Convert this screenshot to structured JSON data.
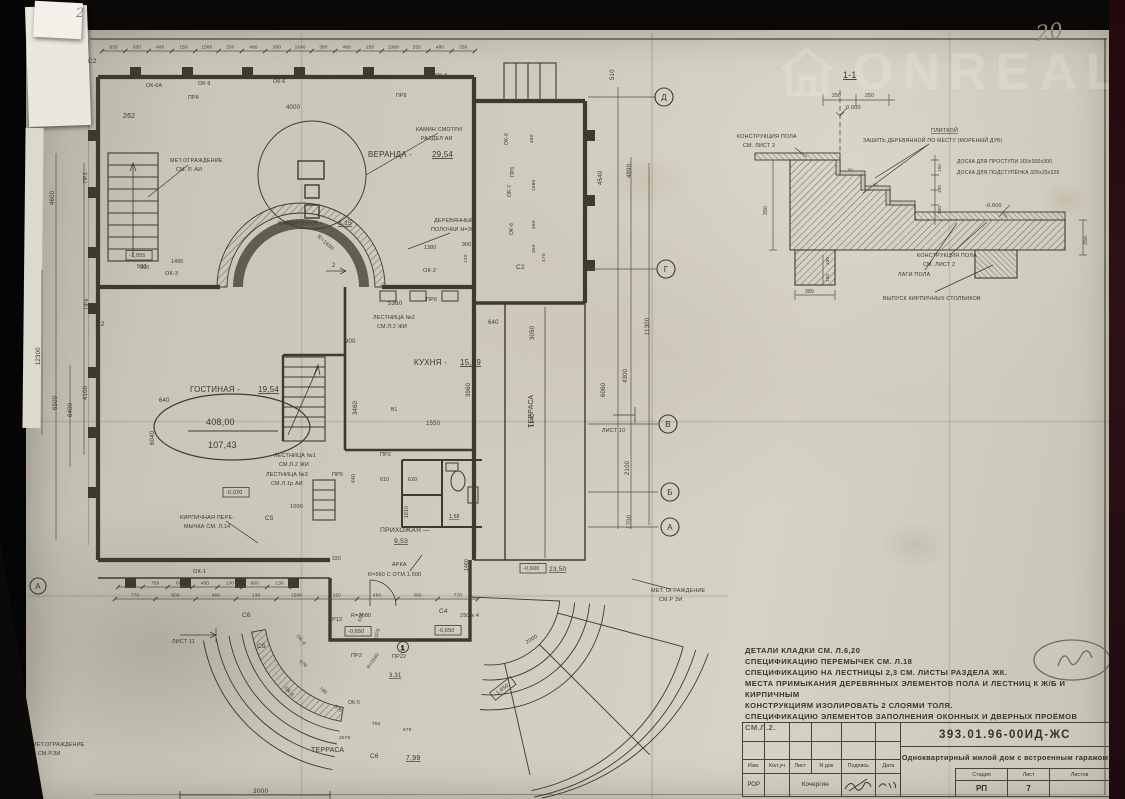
{
  "sheet": {
    "handwritten_page_number": "20",
    "handwritten_corner_note": "2",
    "watermark_text": "ONREAL"
  },
  "plan": {
    "axes_right": [
      {
        "l": "Д",
        "x": 634,
        "y": 62
      },
      {
        "l": "Г",
        "x": 636,
        "y": 234
      },
      {
        "l": "В",
        "x": 638,
        "y": 389
      },
      {
        "l": "Б",
        "x": 640,
        "y": 457
      },
      {
        "l": "А",
        "x": 640,
        "y": 492
      }
    ],
    "axes_left": [
      {
        "l": "А",
        "x": 8,
        "y": 551
      }
    ],
    "chains": [
      {
        "y": 16,
        "x0": 72,
        "x1": 445,
        "values": [
          "835",
          "330",
          "480",
          "150",
          "1580",
          "250",
          "480",
          "360",
          "1640",
          "380",
          "480",
          "250",
          "1380",
          "250",
          "480",
          "330"
        ]
      },
      {
        "y": 552,
        "x0": 88,
        "x1": 262,
        "values": [
          "130",
          "750",
          "600",
          "450",
          "130",
          "600",
          "130"
        ]
      },
      {
        "y": 564,
        "x0": 85,
        "x1": 448,
        "values": [
          "770",
          "500",
          "460",
          "130",
          "1580",
          "150",
          "460",
          "360",
          "770"
        ]
      }
    ],
    "labels": [
      {
        "t": "ПР8",
        "x": 158,
        "y": 64,
        "s": 5.2
      },
      {
        "t": "ОК-6А",
        "x": 116,
        "y": 52,
        "s": 5.2
      },
      {
        "t": "ОК-9",
        "x": 168,
        "y": 50,
        "s": 5.2
      },
      {
        "t": "ОК-6",
        "x": 243,
        "y": 48,
        "s": 5.2
      },
      {
        "t": "ОК-6А",
        "x": 308,
        "y": 44,
        "s": 5.2
      },
      {
        "t": "ОК-7",
        "x": 348,
        "y": 44,
        "s": 5.2
      },
      {
        "t": "ОК-6",
        "x": 405,
        "y": 42,
        "s": 5.2
      },
      {
        "t": "ПР8",
        "x": 366,
        "y": 62,
        "s": 5.2
      },
      {
        "t": "4000",
        "x": 256,
        "y": 74,
        "s": 6
      },
      {
        "t": "262",
        "x": 93,
        "y": 83,
        "s": 7,
        "c": "#7d7a6e"
      },
      {
        "t": "ПР3",
        "x": 57,
        "y": 148,
        "s": 5.2,
        "r": -90
      },
      {
        "t": "ОК-4",
        "x": 70,
        "y": 175,
        "s": 5.2,
        "r": -90
      },
      {
        "t": "ОК-6А",
        "x": 70,
        "y": 214,
        "s": 5.2,
        "r": -90
      },
      {
        "t": "ПР6",
        "x": 58,
        "y": 274,
        "s": 5.2,
        "r": -90
      },
      {
        "t": "ОК-3",
        "x": 135,
        "y": 240,
        "s": 5.5
      },
      {
        "t": "ОК-2",
        "x": 393,
        "y": 237,
        "s": 5.5
      },
      {
        "t": "4600",
        "x": 24,
        "y": 170,
        "s": 6,
        "r": -90
      },
      {
        "t": "12300",
        "x": 10,
        "y": 330,
        "s": 6,
        "r": -90
      },
      {
        "t": "6500",
        "x": 27,
        "y": 375,
        "s": 6,
        "r": -90
      },
      {
        "t": "6400",
        "x": 42,
        "y": 382,
        "s": 6,
        "r": -90
      },
      {
        "t": "4100",
        "x": 57,
        "y": 365,
        "s": 6,
        "r": -90
      },
      {
        "t": "6040",
        "x": 124,
        "y": 410,
        "s": 6,
        "r": -90
      },
      {
        "t": "3460",
        "x": 327,
        "y": 380,
        "s": 6,
        "r": -90
      },
      {
        "t": "3960",
        "x": 440,
        "y": 362,
        "s": 6,
        "r": -90
      },
      {
        "t": "1810",
        "x": 378,
        "y": 483,
        "s": 5,
        "r": -90
      },
      {
        "t": "1460",
        "x": 438,
        "y": 536,
        "s": 5,
        "r": -90
      },
      {
        "t": "3050",
        "x": 504,
        "y": 305,
        "s": 6,
        "r": -90
      },
      {
        "t": "1140",
        "x": 504,
        "y": 392,
        "s": 6,
        "r": -90
      },
      {
        "t": "900",
        "x": 315,
        "y": 308,
        "s": 6
      },
      {
        "t": "5360",
        "x": 358,
        "y": 270,
        "s": 6
      },
      {
        "t": "1550",
        "x": 396,
        "y": 390,
        "s": 6
      },
      {
        "t": "640",
        "x": 458,
        "y": 289,
        "s": 6
      },
      {
        "t": "640",
        "x": 129,
        "y": 367,
        "s": 6
      },
      {
        "t": "610",
        "x": 350,
        "y": 446,
        "s": 5.2
      },
      {
        "t": "620",
        "x": 378,
        "y": 446,
        "s": 5.2
      },
      {
        "t": "1000",
        "x": 260,
        "y": 473,
        "s": 5.5
      },
      {
        "t": "320",
        "x": 302,
        "y": 525,
        "s": 5
      },
      {
        "t": "440",
        "x": 325,
        "y": 448,
        "s": 5,
        "r": -90
      },
      {
        "t": "23,50",
        "x": 519,
        "y": 536,
        "s": 6.5,
        "u": true
      },
      {
        "t": "ГОСТИНАЯ -",
        "x": 160,
        "y": 357,
        "s": 8
      },
      {
        "t": "19,54",
        "x": 228,
        "y": 357,
        "s": 8,
        "u": true
      },
      {
        "t": "408,00",
        "x": 176,
        "y": 390,
        "s": 9
      },
      {
        "t": "107,43",
        "x": 178,
        "y": 413,
        "s": 9
      },
      {
        "t": "КУХНЯ -",
        "x": 384,
        "y": 330,
        "s": 8
      },
      {
        "t": "15,09",
        "x": 430,
        "y": 330,
        "s": 8,
        "u": true
      },
      {
        "t": "ВЕРАНДА -",
        "x": 338,
        "y": 122,
        "s": 8
      },
      {
        "t": "29,54",
        "x": 402,
        "y": 122,
        "s": 8,
        "u": true
      },
      {
        "t": "КАМИННАЯ -",
        "x": 248,
        "y": 190,
        "s": 6.8
      },
      {
        "t": "6,15",
        "x": 308,
        "y": 190,
        "s": 6.8,
        "u": true
      },
      {
        "t": "ПРИХОЖАЯ —",
        "x": 350,
        "y": 497,
        "s": 6.8
      },
      {
        "t": "9,53",
        "x": 364,
        "y": 508,
        "s": 6.8,
        "u": true
      },
      {
        "t": "ТЕРРАСА",
        "x": 503,
        "y": 393,
        "s": 7,
        "r": -90
      },
      {
        "t": "ТЕРРАСА",
        "x": 281,
        "y": 717,
        "s": 7
      },
      {
        "t": "7,99",
        "x": 376,
        "y": 725,
        "s": 7,
        "u": true
      },
      {
        "t": "3,31",
        "x": 359,
        "y": 642,
        "s": 6,
        "u": true
      },
      {
        "t": "1,58",
        "x": 419,
        "y": 483,
        "s": 5,
        "u": true
      },
      {
        "t": "МЕТ.ОГРАЖДЕНИЕ",
        "x": 140,
        "y": 127,
        "s": 5.4
      },
      {
        "t": "СМ. Р. АИ",
        "x": 146,
        "y": 136,
        "s": 5.4
      },
      {
        "t": "КАМИН СМОТРИ",
        "x": 386,
        "y": 96,
        "s": 5.4
      },
      {
        "t": "РАЗДЕЛ АИ",
        "x": 391,
        "y": 105,
        "s": 5.4
      },
      {
        "t": "ДЕРЕВЯННЫЕ",
        "x": 404,
        "y": 187,
        "s": 5.4
      },
      {
        "t": "ПОЛОЧКИ Н=30",
        "x": 401,
        "y": 196,
        "s": 5.4
      },
      {
        "t": "R=1650",
        "x": 287,
        "y": 202,
        "s": 5.4,
        "r": 42
      },
      {
        "t": "ЛЕСТНИЦА №2",
        "x": 343,
        "y": 284,
        "s": 5.4
      },
      {
        "t": "СМ.Л.2 ЖИ",
        "x": 347,
        "y": 293,
        "s": 5.4
      },
      {
        "t": "ЛЕСТНИЦА №1",
        "x": 244,
        "y": 422,
        "s": 5.4
      },
      {
        "t": "СМ.Л.2 ЖИ",
        "x": 249,
        "y": 431,
        "s": 5.4
      },
      {
        "t": "ЛЕСТНИЦА №3",
        "x": 236,
        "y": 441,
        "s": 5.4
      },
      {
        "t": "СМ.Л.1р АИ",
        "x": 241,
        "y": 450,
        "s": 5.4
      },
      {
        "t": "КИРПИЧНАЯ ПЕРЕ-",
        "x": 150,
        "y": 484,
        "s": 5.4
      },
      {
        "t": "МЫЧКА СМ. Л.14",
        "x": 154,
        "y": 493,
        "s": 5.4
      },
      {
        "t": "АРКА",
        "x": 362,
        "y": 531,
        "s": 5.4
      },
      {
        "t": "R=560 С ОТМ.1,500",
        "x": 338,
        "y": 541,
        "s": 5.4
      },
      {
        "t": "МЕТ. ОГРАЖДЕНИЕ",
        "x": 621,
        "y": 557,
        "s": 5.4
      },
      {
        "t": "СМ.Р ЗИ",
        "x": 629,
        "y": 566,
        "s": 5.4
      },
      {
        "t": "МЕТ.ОГРАЖДЕНИЕ",
        "x": 2,
        "y": 711,
        "s": 5.4
      },
      {
        "t": "СМ.Р.ЗИ",
        "x": 8,
        "y": 720,
        "s": 5.4
      },
      {
        "t": "ЛИСТ 10",
        "x": 572,
        "y": 397,
        "s": 5.4
      },
      {
        "t": "ЛИСТ 11",
        "x": 142,
        "y": 608,
        "s": 5.4
      },
      {
        "t": "С2",
        "x": 58,
        "y": 28,
        "s": 6.5
      },
      {
        "t": "С2",
        "x": 66,
        "y": 291,
        "s": 6.5
      },
      {
        "t": "С2",
        "x": 486,
        "y": 234,
        "s": 6.5
      },
      {
        "t": "С4",
        "x": 409,
        "y": 578,
        "s": 6.5
      },
      {
        "t": "С5",
        "x": 235,
        "y": 485,
        "s": 6.5
      },
      {
        "t": "С5",
        "x": 227,
        "y": 613,
        "s": 6.5
      },
      {
        "t": "С6",
        "x": 212,
        "y": 582,
        "s": 6.5
      },
      {
        "t": "С6",
        "x": 340,
        "y": 723,
        "s": 6.5
      },
      {
        "t": "ПР2",
        "x": 350,
        "y": 421,
        "s": 5.4
      },
      {
        "t": "ПР5",
        "x": 302,
        "y": 441,
        "s": 5.4
      },
      {
        "t": "ПР2",
        "x": 321,
        "y": 622,
        "s": 5.4
      },
      {
        "t": "ПР6",
        "x": 396,
        "y": 266,
        "s": 5.4
      },
      {
        "t": "ОК-5",
        "x": 254,
        "y": 653,
        "s": 5,
        "r": 50
      },
      {
        "t": "ОК-5",
        "x": 318,
        "y": 669,
        "s": 5
      },
      {
        "t": "ОК-4",
        "x": 266,
        "y": 601,
        "s": 5,
        "r": 50
      },
      {
        "t": "ПР12",
        "x": 298,
        "y": 586,
        "s": 5.4
      },
      {
        "t": "R=2080",
        "x": 321,
        "y": 582,
        "s": 5.4
      },
      {
        "t": "ПР22",
        "x": 362,
        "y": 623,
        "s": 5.4
      },
      {
        "t": "250 х 4",
        "x": 430,
        "y": 582,
        "s": 5.4
      },
      {
        "t": "2000",
        "x": 497,
        "y": 609,
        "s": 5.4,
        "r": -32
      },
      {
        "t": "518",
        "x": 331,
        "y": 587,
        "s": 4.8,
        "r": -75
      },
      {
        "t": "1070",
        "x": 347,
        "y": 605,
        "s": 4.8,
        "r": -75
      },
      {
        "t": "R=2540",
        "x": 339,
        "y": 634,
        "s": 4.8,
        "r": -55
      },
      {
        "t": "-0,020",
        "x": 196,
        "y": 459,
        "s": 5.4,
        "b": true
      },
      {
        "t": "-0,600",
        "x": 493,
        "y": 535,
        "s": 5.4,
        "b": true
      },
      {
        "t": "-0,650",
        "x": 318,
        "y": 598,
        "s": 5.4,
        "b": true
      },
      {
        "t": "-0,650",
        "x": 408,
        "y": 597,
        "s": 5.4,
        "b": true
      },
      {
        "t": "-1,650",
        "x": 466,
        "y": 661,
        "s": 5.4,
        "b": true,
        "r": -38
      },
      {
        "t": "-1,055",
        "x": 99,
        "y": 222,
        "s": 5.4,
        "b": true
      },
      {
        "t": "500",
        "x": 107,
        "y": 233,
        "s": 5.4
      },
      {
        "t": "570",
        "x": 269,
        "y": 627,
        "s": 4.8,
        "r": 40
      },
      {
        "t": "780",
        "x": 289,
        "y": 654,
        "s": 4.8,
        "r": 40
      },
      {
        "t": "570",
        "x": 304,
        "y": 672,
        "s": 4.8,
        "r": 40
      },
      {
        "t": "750",
        "x": 342,
        "y": 690,
        "s": 4.8
      },
      {
        "t": "675",
        "x": 373,
        "y": 696,
        "s": 4.8
      },
      {
        "t": "2570",
        "x": 309,
        "y": 704,
        "s": 4.8
      },
      {
        "t": "1490",
        "x": 141,
        "y": 228,
        "s": 5.2
      },
      {
        "t": "900",
        "x": 110,
        "y": 234,
        "s": 5.2
      },
      {
        "t": "1380",
        "x": 394,
        "y": 214,
        "s": 5.2
      },
      {
        "t": "900",
        "x": 432,
        "y": 211,
        "s": 5.2
      },
      {
        "t": "120",
        "x": 437,
        "y": 228,
        "s": 4.8,
        "r": -90
      },
      {
        "t": "ОК-6",
        "x": 478,
        "y": 110,
        "s": 5,
        "r": -90
      },
      {
        "t": "ПР6",
        "x": 484,
        "y": 142,
        "s": 5,
        "r": -90
      },
      {
        "t": "ОК-7",
        "x": 481,
        "y": 162,
        "s": 5,
        "r": -90
      },
      {
        "t": "ОК-6",
        "x": 483,
        "y": 200,
        "s": 5,
        "r": -90
      },
      {
        "t": "480",
        "x": 503,
        "y": 108,
        "s": 4.8,
        "r": -90
      },
      {
        "t": "1580",
        "x": 505,
        "y": 156,
        "s": 4.8,
        "r": -90
      },
      {
        "t": "480",
        "x": 505,
        "y": 194,
        "s": 4.8,
        "r": -90
      },
      {
        "t": "360",
        "x": 505,
        "y": 218,
        "s": 4.8,
        "r": -90
      },
      {
        "t": "470",
        "x": 515,
        "y": 227,
        "s": 4.8,
        "r": -90
      },
      {
        "t": "510",
        "x": 584,
        "y": 45,
        "s": 6,
        "r": -90
      },
      {
        "t": "4540",
        "x": 572,
        "y": 150,
        "s": 6,
        "r": -90
      },
      {
        "t": "4890",
        "x": 601,
        "y": 143,
        "s": 6,
        "r": -90
      },
      {
        "t": "6060",
        "x": 575,
        "y": 362,
        "s": 6,
        "r": -90
      },
      {
        "t": "4300",
        "x": 597,
        "y": 348,
        "s": 6,
        "r": -90
      },
      {
        "t": "11300",
        "x": 619,
        "y": 300,
        "s": 6,
        "r": -90
      },
      {
        "t": "2100",
        "x": 599,
        "y": 440,
        "s": 6,
        "r": -90
      },
      {
        "t": "1700",
        "x": 601,
        "y": 494,
        "s": 6,
        "r": -90
      },
      {
        "t": "3000",
        "x": 223,
        "y": 758,
        "s": 6.5
      },
      {
        "t": "В1",
        "x": 361,
        "y": 376,
        "s": 5
      },
      {
        "t": "ОК-1",
        "x": 163,
        "y": 538,
        "s": 5.5
      },
      {
        "t": "2",
        "x": 302,
        "y": 232,
        "s": 6
      }
    ]
  },
  "detail": {
    "labels": [
      {
        "t": "1-1",
        "x": 108,
        "y": 18,
        "s": 9,
        "u": true
      },
      {
        "t": "КОНСТРУКЦИЯ ПОЛА",
        "x": 2,
        "y": 78,
        "s": 5.4
      },
      {
        "t": "СМ. ЛИСТ 2",
        "x": 8,
        "y": 87,
        "s": 5.4
      },
      {
        "t": "ПЛИТКОЙ",
        "x": 196,
        "y": 72,
        "s": 5.4,
        "u": true
      },
      {
        "t": "ЗАШИТЬ ДЕРЕВЯННОЙ ПО МЕСТУ (МОРЕНЫЙ ДУБ)",
        "x": 128,
        "y": 82,
        "s": 5.2
      },
      {
        "t": "ДОСКА ДЛЯ ПРОСТУПИ 300х300х300",
        "x": 222,
        "y": 103,
        "s": 5
      },
      {
        "t": "ДОСКА ДЛЯ ПОДСТУПЁНКА 325х25х325",
        "x": 222,
        "y": 114,
        "s": 5
      },
      {
        "t": "КОНСТРУКЦИЯ ПОЛА",
        "x": 182,
        "y": 197,
        "s": 5.4
      },
      {
        "t": "СМ. ЛИСТ 2",
        "x": 188,
        "y": 206,
        "s": 5.4
      },
      {
        "t": "0.000",
        "x": 111,
        "y": 49,
        "s": 5.5
      },
      {
        "t": "-0.600",
        "x": 250,
        "y": 147,
        "s": 5.5
      },
      {
        "t": "ЛАГИ ПОЛА",
        "x": 163,
        "y": 216,
        "s": 5.4
      },
      {
        "t": "ВЫПУСК КИРПИЧНЫХ СТОЛБИКОВ",
        "x": 148,
        "y": 240,
        "s": 5.4
      },
      {
        "t": "250",
        "x": 97,
        "y": 37,
        "s": 5
      },
      {
        "t": "250",
        "x": 130,
        "y": 37,
        "s": 5
      },
      {
        "t": "50",
        "x": 113,
        "y": 111,
        "s": 4
      },
      {
        "t": "50",
        "x": 138,
        "y": 126,
        "s": 4
      },
      {
        "t": "150",
        "x": 206,
        "y": 112,
        "s": 4.5,
        "r": -90
      },
      {
        "t": "150",
        "x": 206,
        "y": 133,
        "s": 4.5,
        "r": -90
      },
      {
        "t": "150",
        "x": 206,
        "y": 154,
        "s": 4.5,
        "r": -90
      },
      {
        "t": "350",
        "x": 32,
        "y": 155,
        "s": 5,
        "r": -90
      },
      {
        "t": "100",
        "x": 94,
        "y": 205,
        "s": 4.5,
        "r": -90
      },
      {
        "t": "150",
        "x": 94,
        "y": 222,
        "s": 4.5,
        "r": -90
      },
      {
        "t": "380",
        "x": 70,
        "y": 233,
        "s": 5
      },
      {
        "t": "350",
        "x": 352,
        "y": 185,
        "s": 5,
        "r": -90
      }
    ]
  },
  "notes": {
    "lines": [
      "ДЕТАЛИ КЛАДКИ СМ. Л.6,20",
      "СПЕЦИФИКАЦИЮ ПЕРЕМЫЧЕК  СМ. Л.18",
      "СПЕЦИФИКАЦИЮ НА ЛЕСТНИЦЫ 2,3 СМ. ЛИСТЫ РАЗДЕЛА ЖК.",
      "МЕСТА ПРИМЫКАНИЯ ДЕРЕВЯННЫХ ЭЛЕМЕНТОВ ПОЛА И ЛЕСТНИЦ К Ж/Б И КИРПИЧНЫМ",
      "КОНСТРУКЦИЯМ ИЗОЛИРОВАТЬ 2 СЛОЯМИ ТОЛЯ.",
      "СПЕЦИФИКАЦИЮ ЭЛЕМЕНТОВ ЗАПОЛНЕНИЯ ОКОННЫХ И ДВЕРНЫХ ПРОЁМОВ СМ.Л.2."
    ]
  },
  "titleblock": {
    "doc_number": "393.01.96-00ИД-ЖС",
    "project_title": "Одноквартирный жилой дом с встроенным гаражом",
    "columns": [
      "Изм.",
      "Кол.уч",
      "Лист",
      "N док",
      "Подпись",
      "Дата"
    ],
    "row": {
      "c1": "РОР",
      "name": "Кочергин"
    },
    "stage_label": "Стадия",
    "sheet_label": "Лист",
    "sheets_label": "Листов",
    "stage": "РП",
    "sheet_number": "7",
    "sheets_total": ""
  }
}
